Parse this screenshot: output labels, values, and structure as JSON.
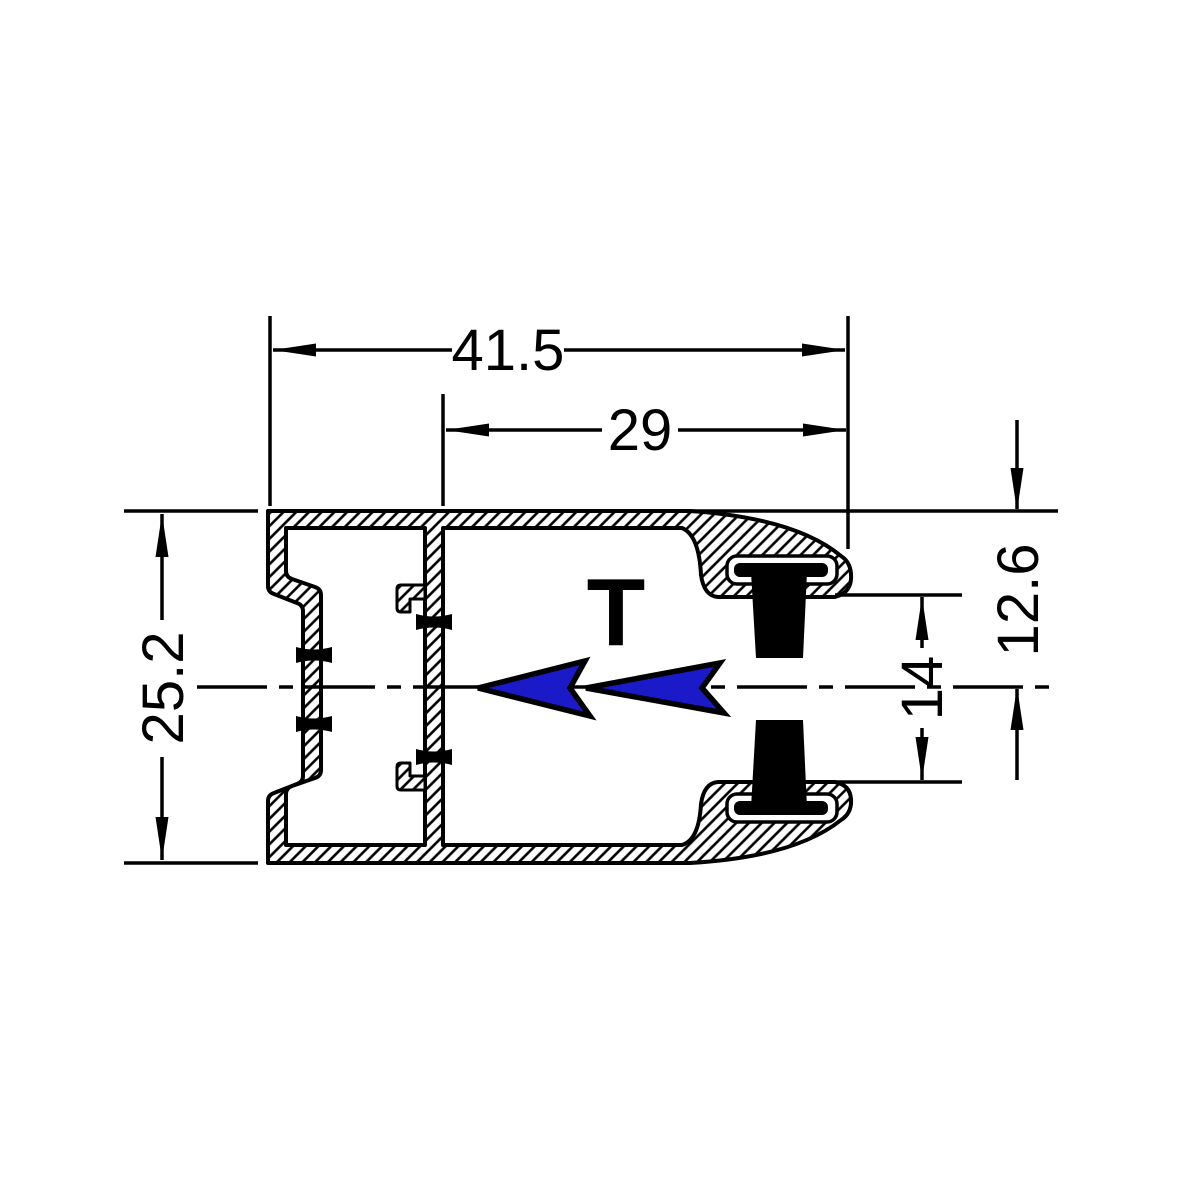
{
  "drawing": {
    "type": "extrusion-cross-section",
    "marker_label": "T",
    "dims": {
      "overall_width": "41.5",
      "chamber_width": "29",
      "overall_height": "25.2",
      "half_height": "12.6",
      "brush_gap": "14"
    },
    "colors": {
      "ink": "#000000",
      "background": "#ffffff",
      "arrow_blue": "#1a1ac8"
    }
  }
}
